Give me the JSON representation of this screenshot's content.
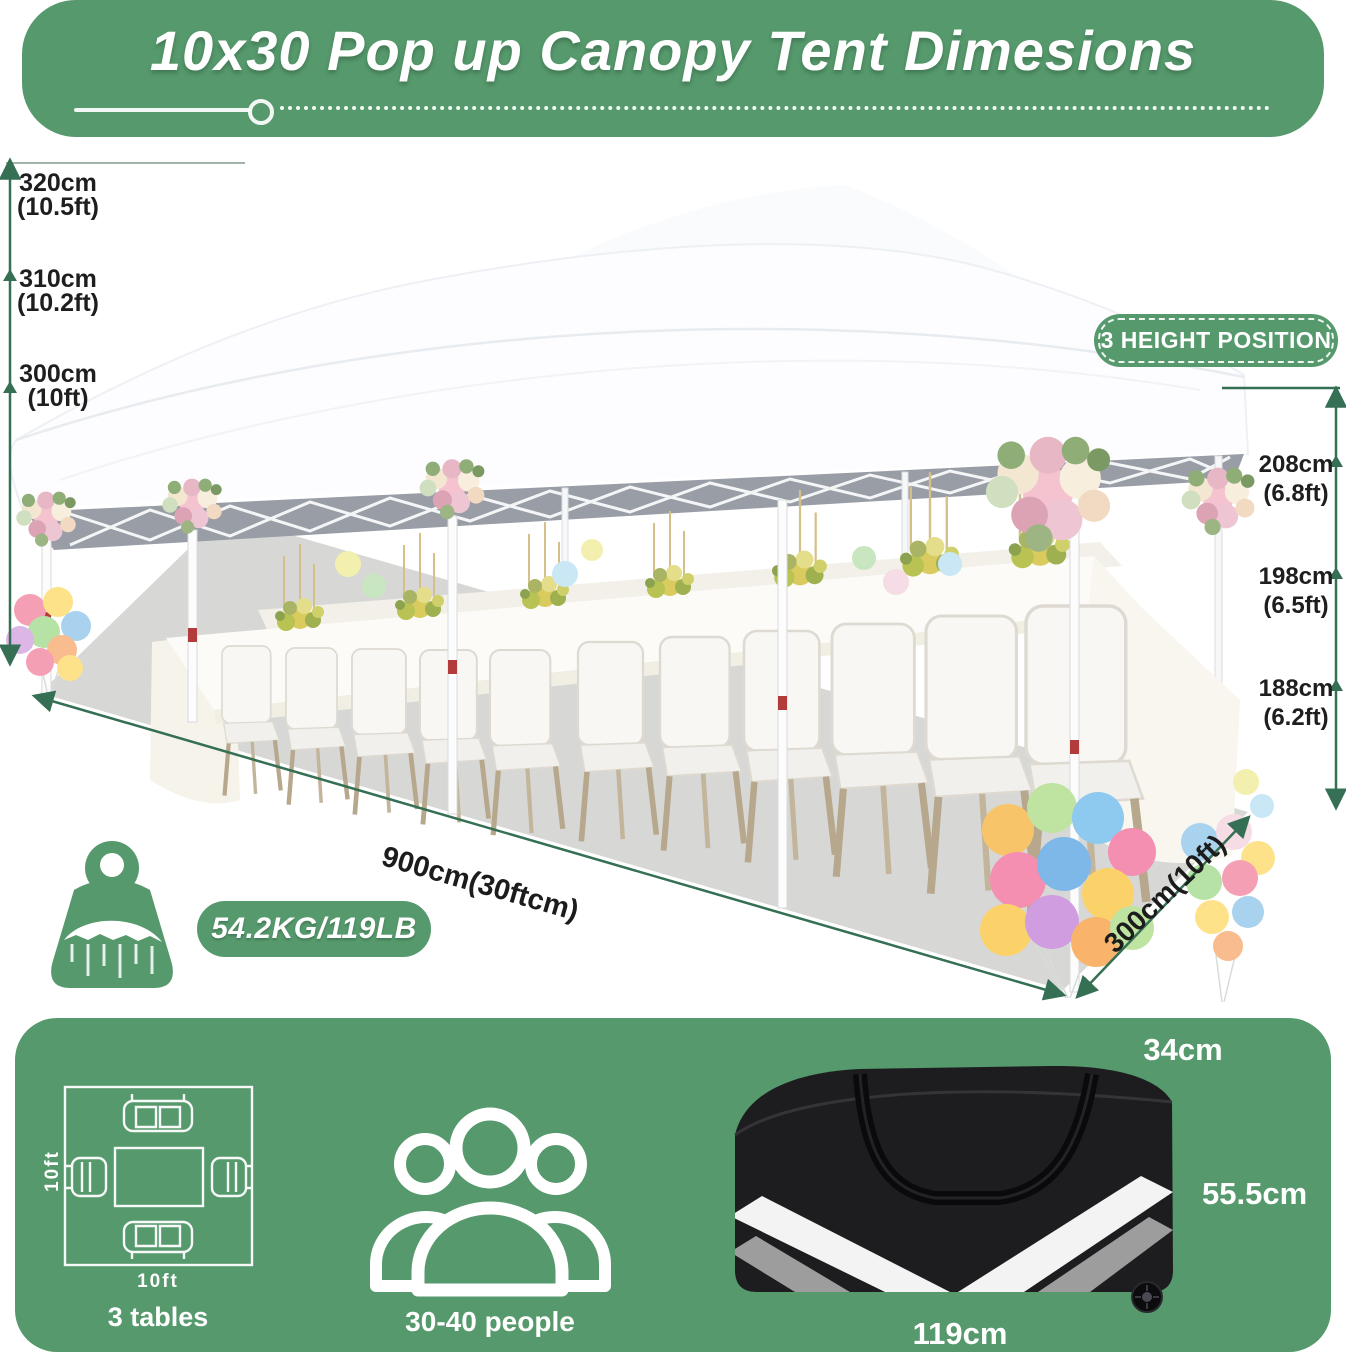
{
  "colors": {
    "brand_green": "#55996c",
    "measure_green": "#356f54",
    "text_dark": "#1e1e1e",
    "white": "#ffffff",
    "bag_black": "#1d1d20",
    "floor_gray": "#d7d8d5",
    "canopy_underside": "#989da6"
  },
  "header": {
    "title": "10x30 Pop up Canopy Tent Dimesions"
  },
  "peak_heights": {
    "items": [
      {
        "cm": "320cm",
        "ft": "(10.5ft)"
      },
      {
        "cm": "310cm",
        "ft": "(10.2ft)"
      },
      {
        "cm": "300cm",
        "ft": "(10ft)"
      }
    ]
  },
  "leg_heights": {
    "badge": "3 HEIGHT POSITION",
    "items": [
      {
        "cm": "208cm",
        "ft": "(6.8ft)"
      },
      {
        "cm": "198cm",
        "ft": "(6.5ft)"
      },
      {
        "cm": "188cm",
        "ft": "(6.2ft)"
      }
    ]
  },
  "ground": {
    "length_label": "900cm(30ftcm)",
    "width_label": "300cm(10ft)"
  },
  "weight": {
    "badge": "54.2KG/119LB"
  },
  "footer": {
    "tables": {
      "height_label": "10ft",
      "width_label": "10ft",
      "caption": "3 tables"
    },
    "people": {
      "caption": "30-40 people"
    },
    "bag": {
      "depth_label": "34cm",
      "height_label": "55.5cm",
      "length_label": "119cm"
    }
  }
}
